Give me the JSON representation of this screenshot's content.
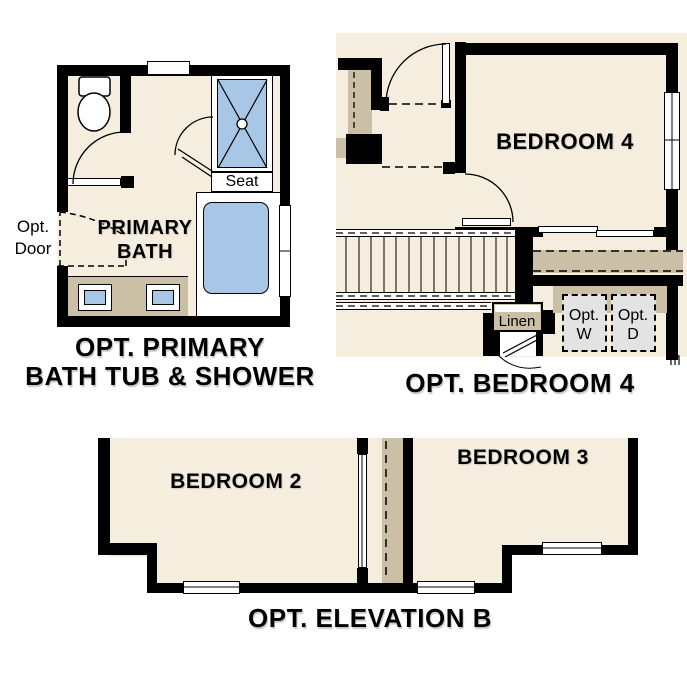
{
  "sheet_title": "floor-plan-options-sheet",
  "colors": {
    "wall": "#000000",
    "floor": "#f5eddd",
    "counter_tan": "#cbbfa6",
    "fixture_blue": "#a8c6e6",
    "appliance_gray": "#e3e3e3",
    "page": "#ffffff",
    "text": "#000000"
  },
  "plans": {
    "primary_bath": {
      "caption_line1": "OPT. PRIMARY",
      "caption_line2": "BATH TUB & SHOWER",
      "room_line1": "PRIMARY",
      "room_line2": "BATH",
      "seat_label": "Seat",
      "opt_door_line1": "Opt.",
      "opt_door_line2": "Door"
    },
    "opt_bedroom4": {
      "caption": "OPT. BEDROOM 4",
      "room_label": "BEDROOM 4",
      "linen_label": "Linen",
      "washer_line1": "Opt.",
      "washer_line2": "W",
      "dryer_line1": "Opt.",
      "dryer_line2": "D"
    },
    "opt_elevation_b": {
      "caption": "OPT. ELEVATION B",
      "bedroom2_label": "BEDROOM 2",
      "bedroom3_label": "BEDROOM 3"
    }
  }
}
